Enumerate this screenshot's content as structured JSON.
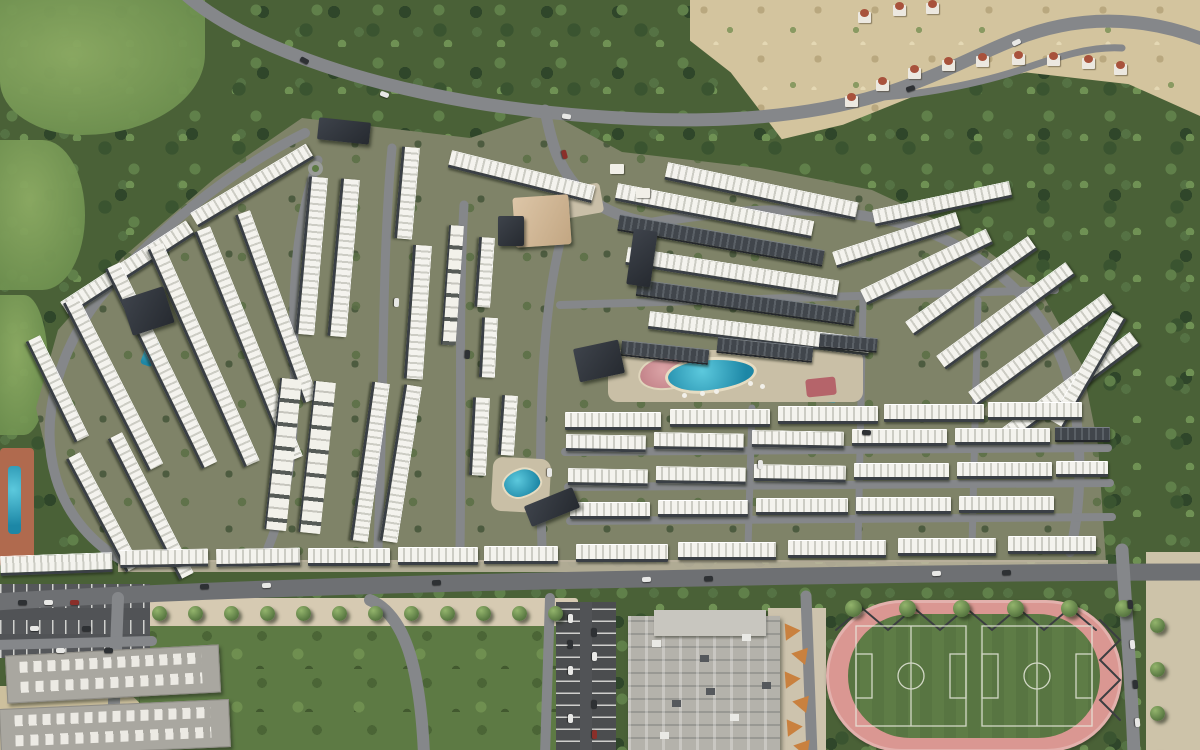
{
  "scene": {
    "palette": {
      "forest": "#4a6137",
      "meadow": "#8cab63",
      "site_ground": "#7f8368",
      "road": "#85878a",
      "road_dark": "#6e7073",
      "roof_white": "#f4f3ee",
      "roof_stripe": "#ccccc4",
      "roof_dark": "#41464c",
      "sand": "#d3c49e",
      "pool_water": "#2f9fb9",
      "track_pink": "#da9792",
      "pitch_green": "#5e7c46",
      "promenade": "#d6cab2",
      "parking_asphalt": "#4b4d4f",
      "building_gray": "#b4b2ab",
      "canopy_orange": "#c9813f",
      "villa_roof": "#a8523c",
      "clubhouse_dark": "#2e333a"
    }
  },
  "features": {
    "rows": [
      [
        60,
        302,
        150,
        13,
        -33,
        0
      ],
      [
        190,
        213,
        135,
        13,
        -31,
        0
      ],
      [
        40,
        335,
        112,
        12,
        64,
        0
      ],
      [
        78,
        296,
        188,
        13,
        63,
        0
      ],
      [
        120,
        262,
        222,
        13,
        64,
        0
      ],
      [
        163,
        243,
        238,
        13,
        66,
        0
      ],
      [
        210,
        226,
        248,
        13,
        68,
        0
      ],
      [
        250,
        210,
        200,
        12,
        70,
        0
      ],
      [
        80,
        452,
        128,
        12,
        62,
        0
      ],
      [
        122,
        432,
        158,
        12,
        63,
        0
      ],
      [
        452,
        150,
        148,
        14,
        14,
        0
      ],
      [
        668,
        162,
        195,
        14,
        12,
        0
      ],
      [
        328,
        178,
        158,
        15,
        95,
        0
      ],
      [
        360,
        180,
        158,
        15,
        95,
        0
      ],
      [
        420,
        148,
        92,
        14,
        95,
        0
      ],
      [
        432,
        246,
        134,
        15,
        94,
        0
      ],
      [
        464,
        226,
        120,
        13,
        94,
        2
      ],
      [
        495,
        238,
        70,
        12,
        94,
        0
      ],
      [
        498,
        318,
        60,
        12,
        93,
        0
      ],
      [
        490,
        398,
        78,
        13,
        93,
        0
      ],
      [
        518,
        396,
        60,
        12,
        94,
        0
      ],
      [
        302,
        380,
        152,
        20,
        96,
        2
      ],
      [
        336,
        383,
        152,
        20,
        96,
        2
      ],
      [
        390,
        384,
        160,
        14,
        98,
        0
      ],
      [
        422,
        387,
        158,
        14,
        99,
        0
      ],
      [
        618,
        183,
        200,
        14,
        11,
        0
      ],
      [
        620,
        214,
        208,
        14,
        10,
        1
      ],
      [
        628,
        247,
        214,
        14,
        9,
        0
      ],
      [
        638,
        279,
        220,
        14,
        8,
        1
      ],
      [
        650,
        311,
        222,
        14,
        7,
        0
      ],
      [
        832,
        252,
        130,
        13,
        -18,
        0
      ],
      [
        860,
        290,
        140,
        13,
        -26,
        0
      ],
      [
        622,
        340,
        88,
        13,
        6,
        1
      ],
      [
        718,
        337,
        96,
        13,
        6,
        1
      ],
      [
        820,
        333,
        58,
        12,
        5,
        1
      ],
      [
        872,
        210,
        140,
        13,
        -12,
        0
      ],
      [
        905,
        322,
        150,
        13,
        -35,
        0
      ],
      [
        936,
        356,
        160,
        13,
        -36,
        0
      ],
      [
        968,
        392,
        168,
        13,
        -36,
        0
      ],
      [
        1002,
        428,
        160,
        13,
        -37,
        0
      ],
      [
        1050,
        420,
        125,
        12,
        -60,
        0
      ],
      [
        565,
        412,
        96,
        14,
        0,
        0
      ],
      [
        670,
        409,
        100,
        14,
        0,
        0
      ],
      [
        778,
        406,
        100,
        14,
        0,
        0
      ],
      [
        884,
        404,
        100,
        14,
        0,
        0
      ],
      [
        988,
        402,
        94,
        14,
        0,
        0
      ],
      [
        566,
        434,
        80,
        13,
        1,
        0
      ],
      [
        654,
        432,
        90,
        13,
        1,
        0
      ],
      [
        752,
        430,
        92,
        13,
        1,
        0
      ],
      [
        852,
        429,
        95,
        13,
        0,
        0
      ],
      [
        955,
        428,
        95,
        13,
        0,
        0
      ],
      [
        1055,
        427,
        55,
        12,
        0,
        1
      ],
      [
        568,
        468,
        80,
        13,
        1,
        0
      ],
      [
        656,
        466,
        90,
        13,
        1,
        0
      ],
      [
        754,
        464,
        92,
        13,
        1,
        0
      ],
      [
        854,
        463,
        95,
        13,
        0,
        0
      ],
      [
        957,
        462,
        95,
        13,
        0,
        0
      ],
      [
        1056,
        461,
        52,
        12,
        0,
        0
      ],
      [
        570,
        502,
        80,
        13,
        0,
        0
      ],
      [
        658,
        500,
        90,
        13,
        0,
        0
      ],
      [
        756,
        498,
        92,
        13,
        0,
        0
      ],
      [
        856,
        497,
        95,
        13,
        0,
        0
      ],
      [
        959,
        496,
        95,
        13,
        0,
        0
      ],
      [
        0,
        556,
        112,
        16,
        -2,
        0
      ],
      [
        120,
        550,
        88,
        14,
        -1,
        0
      ],
      [
        216,
        549,
        84,
        14,
        -1,
        0
      ],
      [
        308,
        548,
        82,
        14,
        0,
        0
      ],
      [
        398,
        547,
        80,
        14,
        0,
        0
      ],
      [
        484,
        546,
        74,
        14,
        0,
        0
      ],
      [
        576,
        544,
        92,
        14,
        0,
        0
      ],
      [
        678,
        542,
        98,
        14,
        0,
        0
      ],
      [
        788,
        540,
        98,
        14,
        0,
        0
      ],
      [
        898,
        538,
        98,
        14,
        0,
        0
      ],
      [
        1008,
        536,
        88,
        14,
        0,
        0
      ]
    ],
    "dark_buildings": [
      [
        318,
        120,
        52,
        22,
        6
      ],
      [
        126,
        292,
        44,
        38,
        -18
      ],
      [
        576,
        344,
        46,
        34,
        -12
      ],
      [
        630,
        230,
        24,
        56,
        8
      ],
      [
        526,
        496,
        52,
        22,
        -22
      ]
    ],
    "villas": [
      [
        845,
        96
      ],
      [
        876,
        80
      ],
      [
        908,
        68
      ],
      [
        942,
        60
      ],
      [
        976,
        56
      ],
      [
        1012,
        54
      ],
      [
        1047,
        55
      ],
      [
        1082,
        58
      ],
      [
        1114,
        64
      ],
      [
        858,
        12
      ],
      [
        893,
        5
      ],
      [
        926,
        3
      ]
    ],
    "roads": [
      {
        "n": "main-road-north",
        "d": "M183,-8 C240,45 380,95 545,112 C680,126 790,122 880,95 C960,70 1000,38 1060,26 C1110,16 1160,22 1205,40",
        "w": 13
      },
      {
        "n": "hillside-road",
        "d": "M868,98 C905,96 965,88 1020,70 C1060,56 1092,46 1122,48",
        "w": 7
      },
      {
        "n": "entrance-road",
        "d": "M545,110 C552,145 558,165 576,186 C596,208 622,218 650,223",
        "w": 11
      },
      {
        "n": "perimeter-road-west",
        "d": "M305,133 C230,170 150,235 98,300 C60,350 38,418 56,478 C68,518 95,545 122,560",
        "w": 10
      },
      {
        "n": "street",
        "d": "M318,160 C300,210 292,270 294,340 C296,430 292,490 268,548",
        "w": 9
      },
      {
        "n": "street",
        "d": "M392,148 C382,250 384,390 378,548",
        "w": 9
      },
      {
        "n": "street",
        "d": "M464,205 C458,305 462,430 460,548",
        "w": 9
      },
      {
        "n": "street",
        "d": "M562,235 C542,310 538,420 542,548",
        "w": 9
      },
      {
        "n": "perimeter-road-east",
        "d": "M650,223 C770,202 880,206 950,242 C1020,278 1058,332 1072,392 C1084,452 1080,512 1070,552",
        "w": 10
      },
      {
        "n": "street",
        "d": "M560,305 L1055,290",
        "w": 8
      },
      {
        "n": "street",
        "d": "M565,452 L1108,448",
        "w": 8
      },
      {
        "n": "street",
        "d": "M568,487 L1110,483",
        "w": 8
      },
      {
        "n": "street",
        "d": "M570,521 L1112,517",
        "w": 8
      },
      {
        "n": "street",
        "d": "M752,408 L748,548",
        "w": 7
      },
      {
        "n": "street",
        "d": "M863,300 L858,548",
        "w": 7
      },
      {
        "n": "street",
        "d": "M978,300 L972,548",
        "w": 7
      },
      {
        "n": "boulevard-south",
        "d": "M-5,602 C150,592 400,583 700,578 C900,574 1050,572 1205,572",
        "w": 17,
        "c": "#6e7073"
      },
      {
        "n": "street",
        "d": "M118,598 L112,755",
        "w": 12
      },
      {
        "n": "street",
        "d": "M-5,645 L152,641",
        "w": 10
      },
      {
        "n": "street",
        "d": "M370,600 C402,614 420,660 424,755",
        "w": 12
      },
      {
        "n": "street",
        "d": "M550,598 L545,755",
        "w": 10
      },
      {
        "n": "street",
        "d": "M806,596 L812,755",
        "w": 11
      },
      {
        "n": "road-east",
        "d": "M1122,550 C1128,640 1132,700 1134,755",
        "w": 13
      },
      {
        "n": "lazy-river-pool",
        "d": "M655,399 C720,396 780,396 834,400",
        "w": 5,
        "c": "#2f9fb9"
      },
      {
        "n": "shade-canopy-zigzag",
        "d": "M836,630 L862,608 L888,630 L914,608 L940,630 L966,608 L992,630 L1018,608 L1044,630 L1070,608 L1096,630",
        "w": 2,
        "c": "#3b3e41"
      },
      {
        "n": "shade-canopy-zigzag",
        "d": "M1100,620 L1120,640 L1100,660 L1120,680 L1100,700 L1120,720",
        "w": 2,
        "c": "#3b3e41"
      }
    ],
    "cars": [
      [
        300,
        58,
        28,
        "d"
      ],
      [
        380,
        92,
        20,
        "w"
      ],
      [
        562,
        114,
        8,
        "w"
      ],
      [
        906,
        86,
        -18,
        "d"
      ],
      [
        1012,
        40,
        -25,
        "w"
      ],
      [
        560,
        152,
        75,
        "r"
      ],
      [
        200,
        584,
        -2,
        "d"
      ],
      [
        262,
        583,
        -2,
        "w"
      ],
      [
        432,
        580,
        -2,
        "d"
      ],
      [
        642,
        577,
        -2,
        "w"
      ],
      [
        704,
        576,
        -2,
        "d"
      ],
      [
        932,
        571,
        -2,
        "w"
      ],
      [
        1002,
        570,
        -2,
        "d"
      ],
      [
        1126,
        602,
        85,
        "d"
      ],
      [
        1128,
        642,
        85,
        "w"
      ],
      [
        1131,
        682,
        85,
        "d"
      ],
      [
        1133,
        720,
        85,
        "w"
      ],
      [
        392,
        300,
        92,
        "w"
      ],
      [
        463,
        352,
        93,
        "d"
      ],
      [
        545,
        470,
        90,
        "w"
      ],
      [
        862,
        430,
        2,
        "d"
      ],
      [
        756,
        462,
        88,
        "w"
      ]
    ],
    "lot_cars": [
      [
        18,
        600,
        0,
        "d"
      ],
      [
        44,
        600,
        0,
        "w"
      ],
      [
        70,
        600,
        0,
        "r"
      ],
      [
        30,
        626,
        0,
        "w"
      ],
      [
        82,
        626,
        0,
        "d"
      ],
      [
        56,
        648,
        0,
        "w"
      ],
      [
        104,
        648,
        0,
        "d"
      ],
      [
        566,
        616,
        90,
        "w"
      ],
      [
        566,
        642,
        90,
        "d"
      ],
      [
        566,
        668,
        90,
        "w"
      ],
      [
        590,
        630,
        90,
        "d"
      ],
      [
        590,
        654,
        90,
        "w"
      ],
      [
        590,
        702,
        90,
        "d"
      ],
      [
        566,
        716,
        90,
        "w"
      ],
      [
        590,
        732,
        90,
        "r"
      ]
    ],
    "promenade_trees": {
      "x0": 152,
      "y": 606,
      "dx": 36,
      "n": 12
    },
    "track_trees": {
      "x0": 845,
      "y": 600,
      "dx": 54,
      "n": 6
    },
    "east_trees": {
      "x": 1150,
      "y0": 618,
      "dy": 44,
      "n": 4
    },
    "mall_units": [
      [
        652,
        640
      ],
      [
        700,
        655
      ],
      [
        742,
        634
      ],
      [
        672,
        700
      ],
      [
        730,
        714
      ],
      [
        762,
        682
      ],
      [
        660,
        732
      ],
      [
        706,
        688
      ]
    ],
    "canopies": [
      [
        780,
        622
      ],
      [
        794,
        646
      ],
      [
        780,
        670
      ],
      [
        795,
        694
      ],
      [
        782,
        718
      ],
      [
        796,
        738
      ]
    ],
    "cabanas": [
      [
        700,
        391
      ],
      [
        714,
        389
      ],
      [
        682,
        393
      ],
      [
        748,
        381
      ],
      [
        760,
        384
      ]
    ],
    "gate_pavilions": [
      [
        610,
        164
      ],
      [
        636,
        188
      ]
    ]
  }
}
